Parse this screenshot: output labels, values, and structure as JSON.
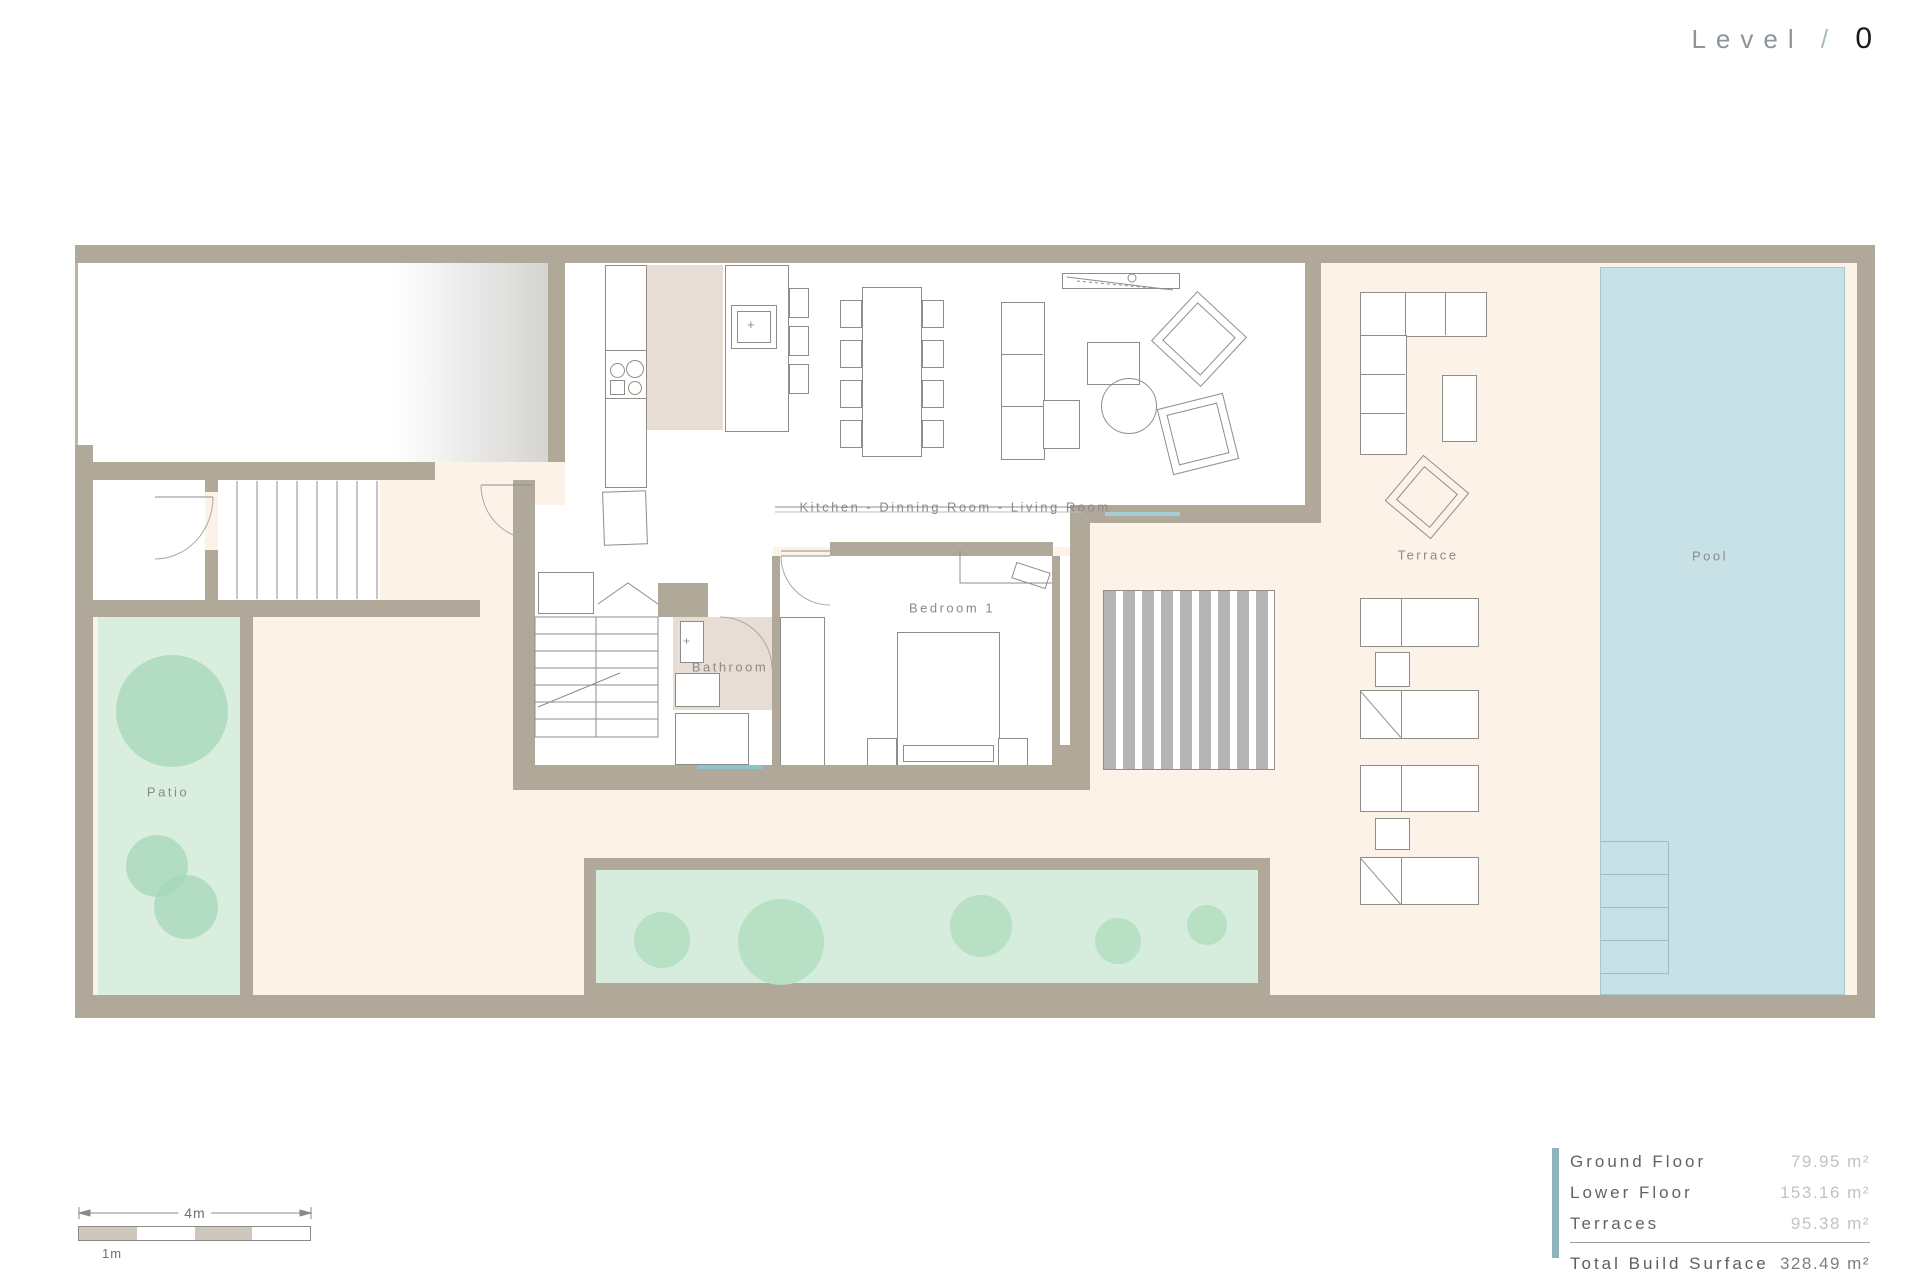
{
  "header": {
    "level_label": "Level",
    "level_sep": "/",
    "level_value": "0"
  },
  "rooms": {
    "kitchen_living": "Kitchen - Dinning Room - Living Room",
    "bedroom": "Bedroom 1",
    "bathroom": "Bathroom",
    "patio": "Patio",
    "terrace": "Terrace",
    "pool": "Pool"
  },
  "legend": {
    "rows": [
      {
        "label": "Ground Floor",
        "value": "79.95 m²"
      },
      {
        "label": "Lower Floor",
        "value": "153.16 m²"
      },
      {
        "label": "Terraces",
        "value": "95.38 m²"
      }
    ],
    "total_label": "Total Build Surface",
    "total_value": "328.49 m²"
  },
  "scale_bar": {
    "overall": "4m",
    "unit": "1m"
  },
  "colors": {
    "wall": "#b0a999",
    "outdoor_cream": "#fcf2e7",
    "pool_blue": "#c8e1e7",
    "patio_green": "#d9eedf",
    "planter_green": "#d6ecdc",
    "tile_pink": "#e8ddd5",
    "accent_bar": "#8fb3ba",
    "louver_gray": "#b5b5b5"
  }
}
